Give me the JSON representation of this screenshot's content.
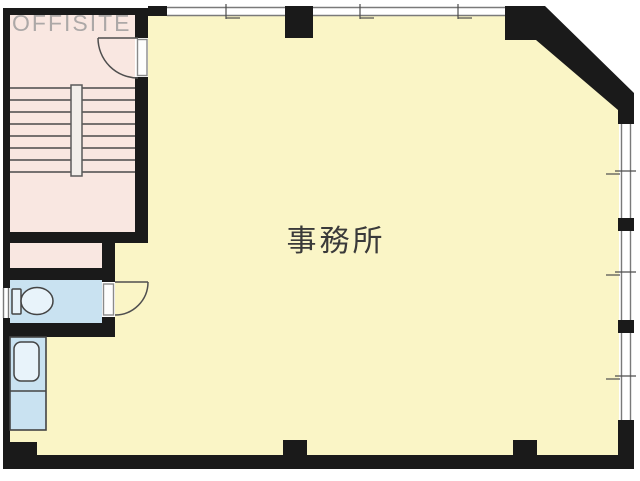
{
  "plan": {
    "office": {
      "label": "事務所"
    },
    "watermark": {
      "text": "OFFISITE"
    },
    "fixtures": {
      "stairs": "staircase",
      "toilet": "toilet",
      "sink": "kitchenette-sink",
      "doors": "swing-doors",
      "windows": "sliding-windows"
    }
  },
  "colors": {
    "wall": "#1A1A1A",
    "office_floor": "#FAF5C6",
    "stair_area": "#F9E7E1",
    "wet_area": "#C9E2F1",
    "fixture_fill": "#E8F3FA",
    "label_text": "#3A3A3A",
    "watermark_text": "#999999",
    "background": "#FFFFFF"
  }
}
